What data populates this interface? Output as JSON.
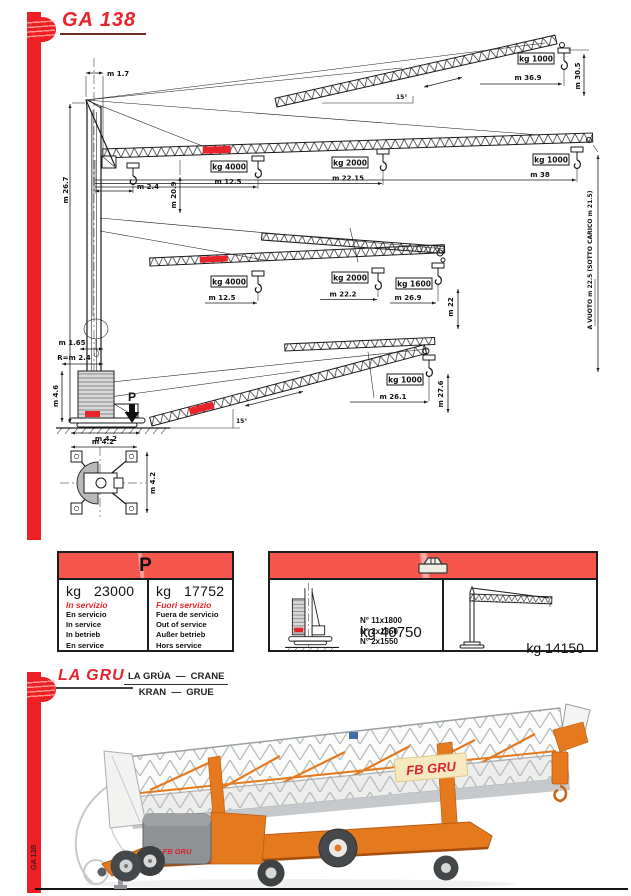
{
  "page": {
    "bottom_tab": "GA 138"
  },
  "colors": {
    "accent_red": "#e8232a",
    "bar_red": "#ee2024",
    "table_header_red": "#f4564e",
    "crane_orange": "#e5791e"
  },
  "diagram": {
    "title": "GA 138",
    "mast": {
      "top_offset": "m 1.7",
      "apex_height": "m 26.7",
      "mast_width": "m 1.65",
      "tail_radius": "R=m 2.4",
      "ballast_height": "m 4.6",
      "base_width": "m 4.2",
      "load_symbol": "P"
    },
    "plan": {
      "width": "m 4.2",
      "depth": "m 4.2"
    },
    "config_top": {
      "angle": "15°",
      "load": "kg 1000",
      "radius": "m 36.9",
      "height": "m 30.5"
    },
    "config_horizontal": {
      "radius0": "m 2.4",
      "load1": "kg 4000",
      "radius1": "m 12.5",
      "load2": "kg 2000",
      "radius2": "m 22.15",
      "load3": "kg 1000",
      "radius3": "m 38",
      "hook_height": "m 20.9",
      "tip_height_note": "A VUOTO m 22.5    (SOTTO CARICO m 21.5)"
    },
    "config_mid": {
      "load1": "kg 4000",
      "radius1": "m 12.5",
      "load2": "kg 2000",
      "radius2": "m 22.2",
      "load3": "kg 1600",
      "radius3": "m 26.9",
      "height": "m 22"
    },
    "config_low": {
      "angle": "15°",
      "load": "kg 1000",
      "radius": "m 26.1",
      "height": "m 27.6"
    }
  },
  "weight_table": {
    "header": "P",
    "in_service": {
      "value": "kg   23000",
      "label_it": "In servizio",
      "labels": [
        "En servicio",
        "In service",
        "In betrieb",
        "En service"
      ]
    },
    "out_of_service": {
      "value": "kg   17752",
      "label_it": "Fuori servizio",
      "labels": [
        "Fuera de servicio",
        "Out of service",
        "Außer betrieb",
        "Hors service"
      ]
    }
  },
  "ballast_table": {
    "blocks": [
      "N° 11x1800",
      "N° 2x1850",
      "N° 2x1550"
    ],
    "total_weight": "kg 40750",
    "crane_weight": "kg 14150"
  },
  "gru_section": {
    "title": "LA GRU",
    "subtitle_line1": "LA GRÚA  —  CRANE",
    "subtitle_line2": "KRAN  —  GRUE",
    "brand_panel": "FB GRU",
    "brand_box": "FB GRU"
  }
}
